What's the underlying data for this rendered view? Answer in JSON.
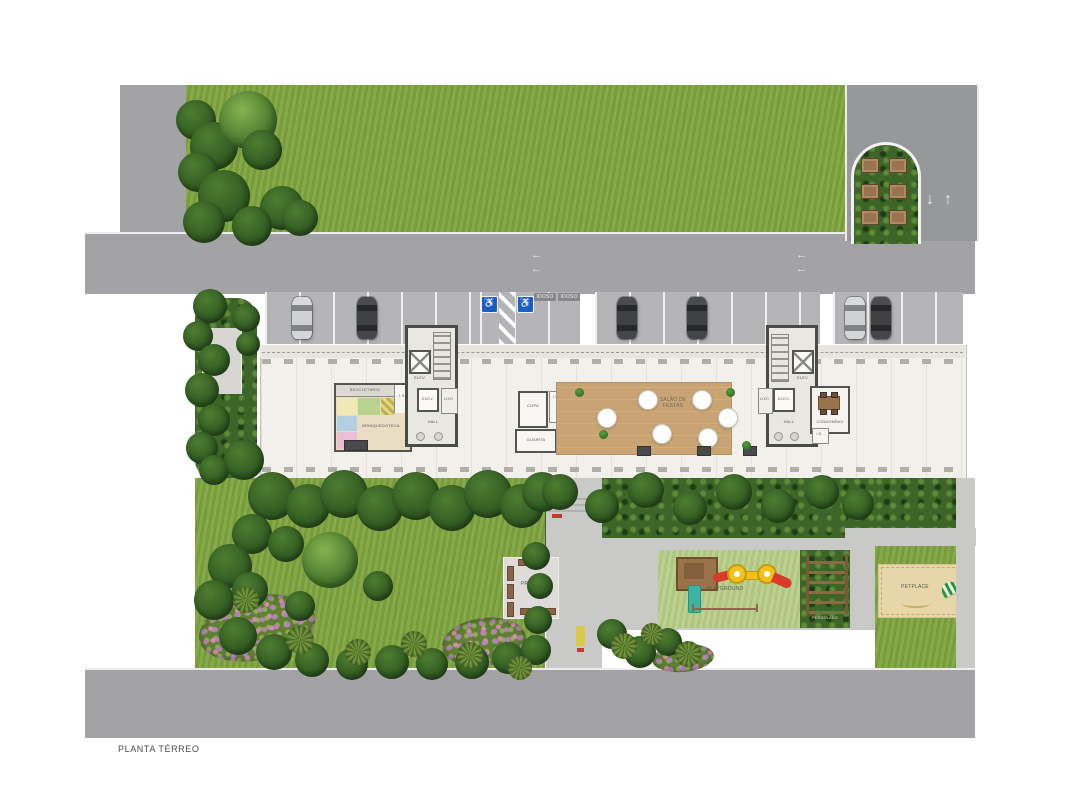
{
  "title": "PLANTA TÉRREO",
  "building": {
    "bicicletario": "BICICLETÁRIO",
    "brinquedoteca": "BRINQUEDOTECA",
    "is": "I.S.",
    "elev": "ELEV.",
    "hall": "HALL",
    "lixo": "LIXO",
    "copa": "COPA",
    "guarita": "GUARITA",
    "salao_festas": "SALÃO DE FESTAS",
    "condominio": "CONDOMÍNIO"
  },
  "outdoor": {
    "gas": "GÁS",
    "praca": "PRAÇA",
    "playground": "PLAYGROUND",
    "pergolado": "PERGOLADO",
    "petplace": "PETPLACE"
  },
  "parking": {
    "idoso": "IDOSO"
  },
  "icons": {
    "wheelchair": "♿",
    "arrow_up": "↑",
    "arrow_down": "↓",
    "arrow_left": "←"
  },
  "colors": {
    "lawn": "#7ea43e",
    "hedge": "#3c6527",
    "road": "#a3a3a5",
    "wood_floor": "#c9a371",
    "sand": "#e7d6a8",
    "accessible_blue": "#1b5fc4",
    "play_red": "#d93b2b",
    "play_yellow": "#f2c21a",
    "play_teal": "#3db3a3"
  }
}
